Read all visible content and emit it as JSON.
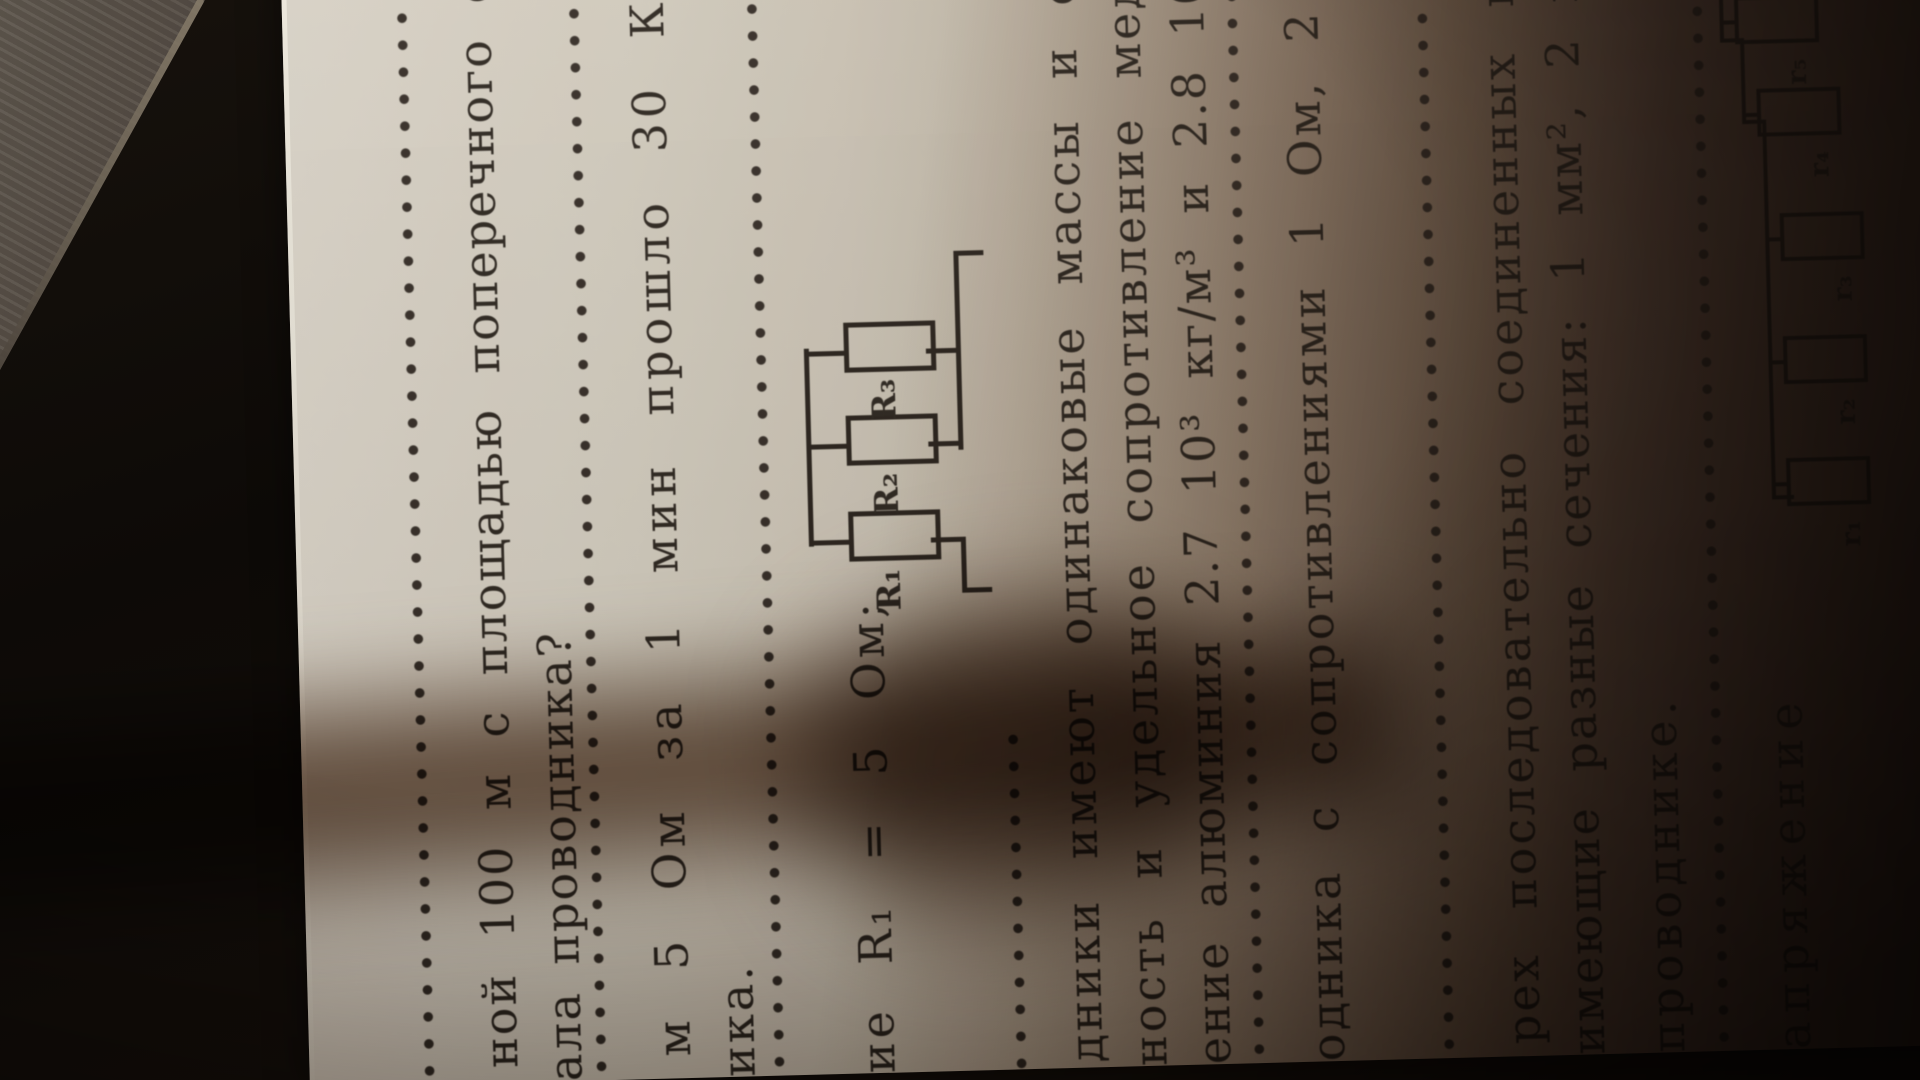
{
  "doc": {
    "language": "Russian",
    "kind": "physics-problems-textbook-page-photo",
    "lines": [
      "ной 100 м с площадью поперечного сечения",
      "ала проводника?",
      "м 5 Ом за 1 мин прошло 30 Кл электри",
      "ика.",
      "ие R₁ = 5 Ом;",
      "дники имеют одинаковые массы и сопроти",
      "ность и удельное сопротивление меди 8.9",
      "ение алюминия 2.7 10³ кг/м³ и 2.8 10⁻⁸ Ом",
      "одника с сопротивлениями 1 Ом, 2 Ом, 3",
      "рех последовательно соединенных куско",
      "имеющие разные сечения: 1 мм², 2 мм², 3 м",
      "проводнике.",
      "апряжение"
    ],
    "figure1": {
      "type": "circuit-r1-series-with-r2-r3-parallel",
      "labels": [
        "R₁",
        "R₂",
        "R₃"
      ]
    },
    "figure2": {
      "type": "circuit-ladder-five-resistors",
      "labels": [
        "r₁",
        "r₂",
        "r₃",
        "r₄",
        "r₅"
      ]
    },
    "colors": {
      "paper": "#d1cabc",
      "ink": "#2a231c",
      "table_wood": "#544c44",
      "shadow": "#1a120c"
    }
  }
}
